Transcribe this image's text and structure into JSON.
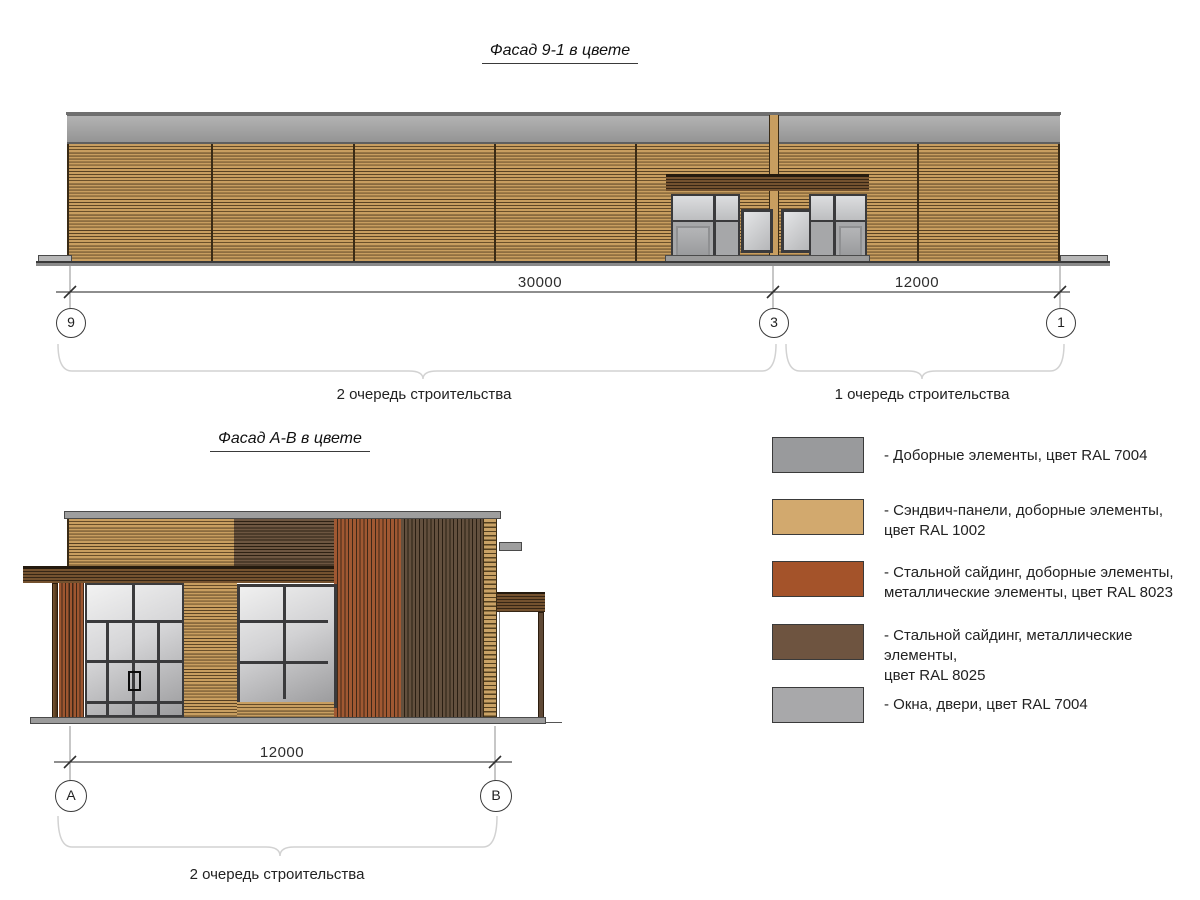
{
  "titles": {
    "facade91": "Фасад 9-1 в цвете",
    "facadeAB": "Фасад А-В в цвете"
  },
  "dims_top": {
    "span_left": "30000",
    "span_right": "12000",
    "axis_left": "9",
    "axis_mid": "3",
    "axis_right": "1"
  },
  "dims_bottom": {
    "span": "12000",
    "axis_left": "А",
    "axis_right": "В"
  },
  "phases": {
    "top_left": "2 очередь строительства",
    "top_right": "1 очередь строительства",
    "bottom": "2 очередь строительства"
  },
  "legend": {
    "items": [
      {
        "color": "#999a9c",
        "label": "- Доборные элементы, цвет RAL 7004"
      },
      {
        "color": "#d2a96e",
        "label": "- Сэндвич-панели, доборные элементы,\nцвет RAL 1002"
      },
      {
        "color": "#a4532a",
        "label": "- Стальной сайдинг, доборные элементы,\nметаллические элементы, цвет RAL 8023"
      },
      {
        "color": "#6e5440",
        "label": "- Стальной сайдинг, металлические элементы,\nцвет RAL 8025"
      },
      {
        "color": "#a8a8aa",
        "label": "- Окна, двери, цвет RAL 7004"
      }
    ]
  },
  "palette": {
    "ral7004_elements": "#999a9c",
    "ral1002_sandwich": "#d2a96e",
    "ral8023_siding": "#a4532a",
    "ral8025_siding": "#6e5440",
    "ral7004_windows": "#a8a8aa"
  }
}
